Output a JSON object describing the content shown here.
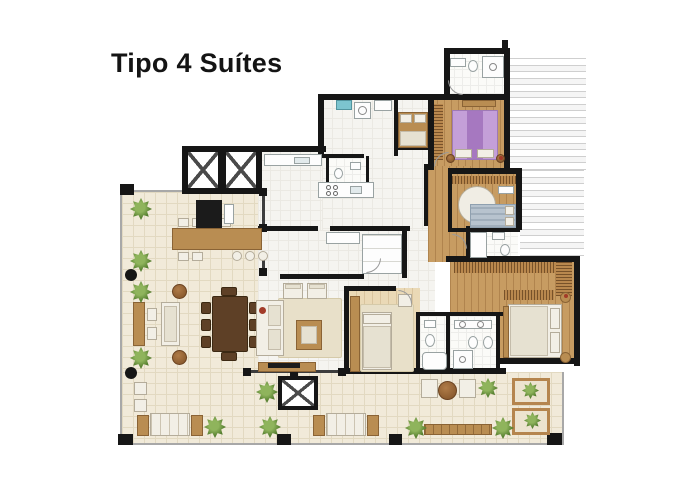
{
  "title": "Tipo 4 Suítes",
  "palette": {
    "ink": "#141414",
    "wall": "#161616",
    "terrace_tile": "#f1ead9",
    "interior_floor": "#f5f4f0",
    "wood_floor": "#c79c62",
    "closet_wood": "#b9884e",
    "furniture_wood": "#b98d52",
    "dining_wood": "#5e4026",
    "fabric_white": "#f2efe6",
    "rug_beige": "#e8e0c9",
    "bed_purple": "#c49fd8",
    "bed_blue": "#b7c3ce",
    "plant_green": "#4e7a2e",
    "pouf_brown": "#9a6a3c",
    "laundry_blue": "#7cc4cf",
    "accent_red": "#a23b28"
  }
}
